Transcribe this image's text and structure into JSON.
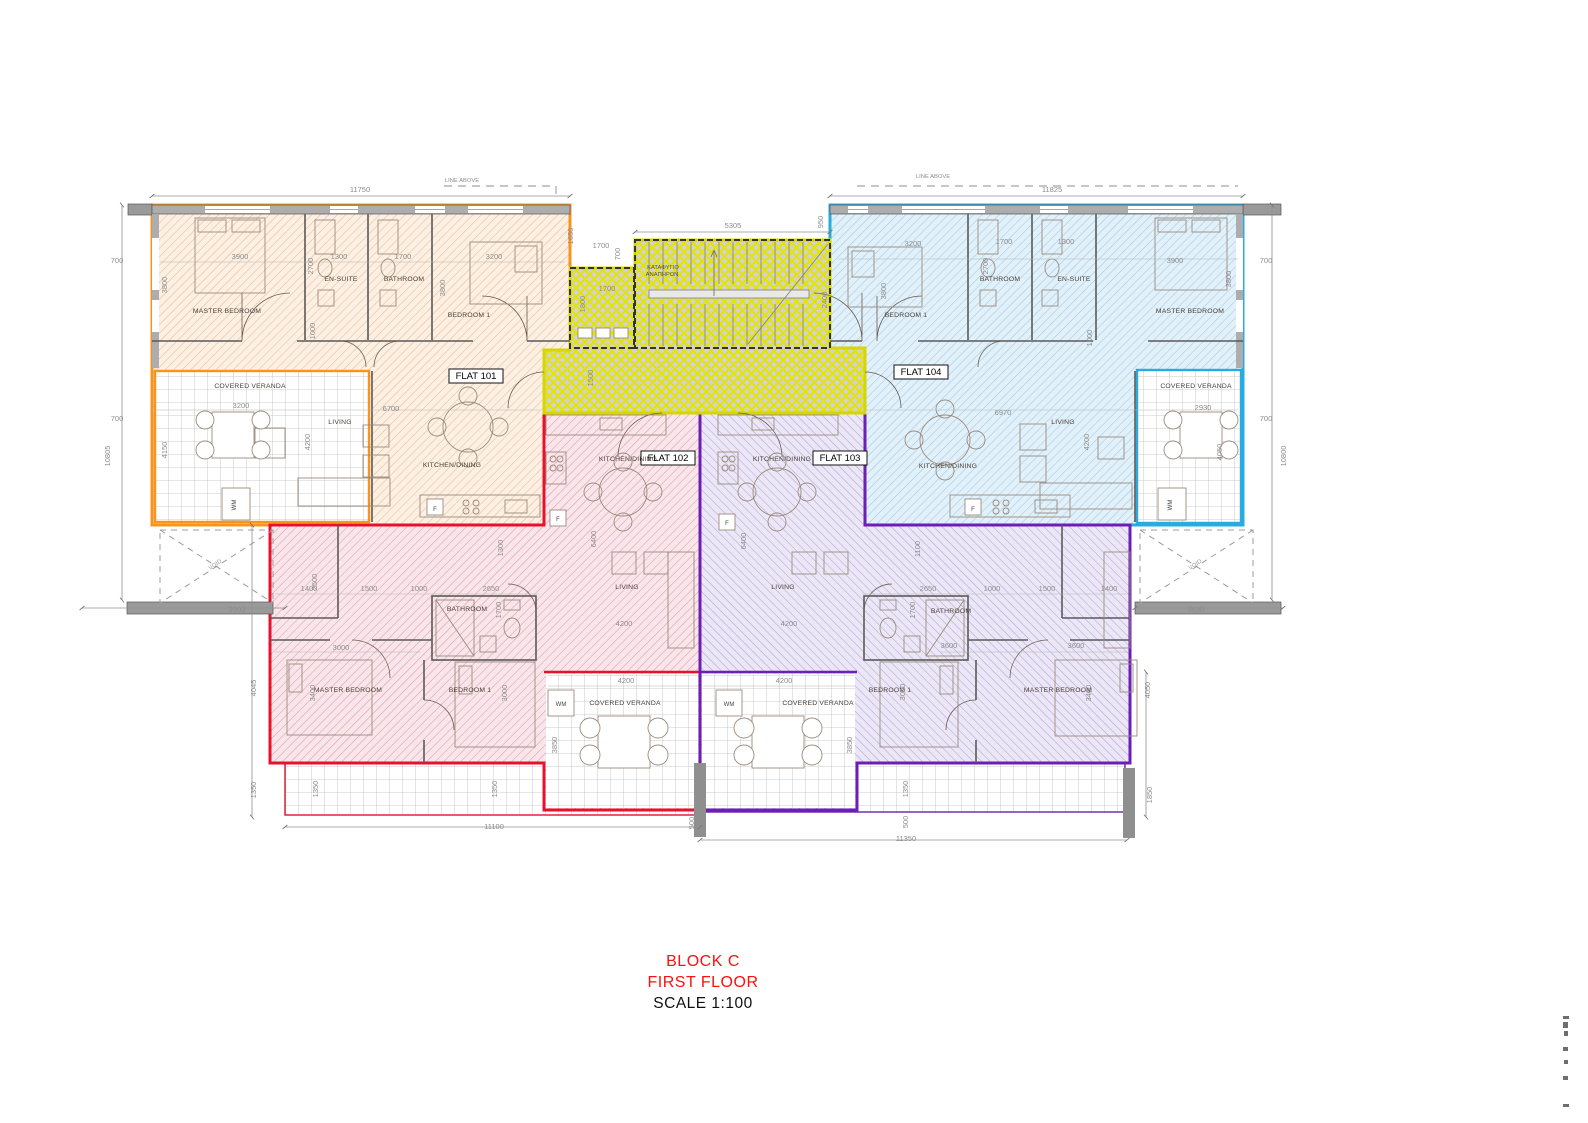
{
  "document": {
    "type": "architectural-floor-plan",
    "sheet_width_px": 1588,
    "sheet_height_px": 1123
  },
  "title": {
    "block": "BLOCK C",
    "floor": "FIRST FLOOR",
    "scale": "SCALE 1:100"
  },
  "colors": {
    "flat101_border": "#F7941E",
    "flat102_border": "#E8112D",
    "flat103_border": "#6C1EB5",
    "flat104_border": "#29ABE2",
    "core_border": "#D6D600",
    "core_hatch": "#E8E800",
    "dim_text": "#8C8C8C",
    "room_text": "#4A4038",
    "title_red": "#FF0F0F"
  },
  "flats": [
    {
      "id": "FLAT 101",
      "position": "top-left",
      "border": "#F7941E",
      "rooms": [
        "MASTER BEDROOM",
        "EN-SUITE",
        "BATHROOM",
        "BEDROOM 1",
        "LIVING",
        "KITCHEN/DINING",
        "COVERED VERANDA"
      ]
    },
    {
      "id": "FLAT 102",
      "position": "bottom-left",
      "border": "#E8112D",
      "rooms": [
        "KITCHEN/DINING",
        "LIVING",
        "BATHROOM",
        "MASTER BEDROOM",
        "BEDROOM 1",
        "COVERED VERANDA"
      ]
    },
    {
      "id": "FLAT 103",
      "position": "bottom-right",
      "border": "#6C1EB5",
      "rooms": [
        "KITCHEN/DINING",
        "LIVING",
        "BATHROOM",
        "BEDROOM 1",
        "MASTER BEDROOM",
        "COVERED VERANDA"
      ]
    },
    {
      "id": "FLAT 104",
      "position": "top-right",
      "border": "#29ABE2",
      "rooms": [
        "BEDROOM 1",
        "BATHROOM",
        "EN-SUITE",
        "MASTER BEDROOM",
        "LIVING",
        "KITCHEN/DINING",
        "COVERED VERANDA"
      ]
    }
  ],
  "core_labels": [
    {
      "t": "ΚΑΤΑΦΥΓΙΟ",
      "x": 663,
      "y": 269
    },
    {
      "t": "ΑΝΑΠΗΡΩΝ",
      "x": 662,
      "y": 276
    }
  ],
  "flat_tags": [
    {
      "t": "FLAT 101",
      "x": 476,
      "y": 379
    },
    {
      "t": "FLAT 102",
      "x": 668,
      "y": 461
    },
    {
      "t": "FLAT 103",
      "x": 840,
      "y": 461
    },
    {
      "t": "FLAT 104",
      "x": 921,
      "y": 375
    }
  ],
  "room_labels": [
    {
      "t": "MASTER BEDROOM",
      "x": 227,
      "y": 313
    },
    {
      "t": "EN-SUITE",
      "x": 341,
      "y": 281
    },
    {
      "t": "BATHROOM",
      "x": 404,
      "y": 281
    },
    {
      "t": "BEDROOM 1",
      "x": 469,
      "y": 317
    },
    {
      "t": "COVERED VERANDA",
      "x": 250,
      "y": 388
    },
    {
      "t": "LIVING",
      "x": 340,
      "y": 424
    },
    {
      "t": "KITCHEN/DINING",
      "x": 452,
      "y": 467
    },
    {
      "t": "BEDROOM 1",
      "x": 906,
      "y": 317
    },
    {
      "t": "BATHROOM",
      "x": 1000,
      "y": 281
    },
    {
      "t": "EN-SUITE",
      "x": 1074,
      "y": 281
    },
    {
      "t": "MASTER BEDROOM",
      "x": 1190,
      "y": 313
    },
    {
      "t": "LIVING",
      "x": 1063,
      "y": 424
    },
    {
      "t": "KITCHEN/DINING",
      "x": 948,
      "y": 468
    },
    {
      "t": "COVERED VERANDA",
      "x": 1196,
      "y": 388
    },
    {
      "t": "KITCHEN/DINING",
      "x": 628,
      "y": 461
    },
    {
      "t": "LIVING",
      "x": 627,
      "y": 589
    },
    {
      "t": "BATHROOM",
      "x": 467,
      "y": 611
    },
    {
      "t": "MASTER BEDROOM",
      "x": 348,
      "y": 692
    },
    {
      "t": "BEDROOM 1",
      "x": 470,
      "y": 692
    },
    {
      "t": "COVERED VERANDA",
      "x": 625,
      "y": 705
    },
    {
      "t": "KITCHEN/DINING",
      "x": 782,
      "y": 461
    },
    {
      "t": "LIVING",
      "x": 783,
      "y": 589
    },
    {
      "t": "BATHROOM",
      "x": 951,
      "y": 613
    },
    {
      "t": "BEDROOM 1",
      "x": 890,
      "y": 692
    },
    {
      "t": "MASTER BEDROOM",
      "x": 1058,
      "y": 692
    },
    {
      "t": "COVERED VERANDA",
      "x": 818,
      "y": 705
    }
  ],
  "appliance_labels": [
    {
      "t": "F",
      "x": 435,
      "y": 511
    },
    {
      "t": "F",
      "x": 973,
      "y": 511
    },
    {
      "t": "F",
      "x": 558,
      "y": 521
    },
    {
      "t": "F",
      "x": 727,
      "y": 525
    },
    {
      "t": "WM",
      "x": 236,
      "y": 505,
      "r": -90
    },
    {
      "t": "WM",
      "x": 1172,
      "y": 505,
      "r": -90
    },
    {
      "t": "WM",
      "x": 561,
      "y": 706
    },
    {
      "t": "WM",
      "x": 729,
      "y": 706
    }
  ],
  "void_labels": [
    {
      "t": "VOID",
      "x": 216,
      "y": 566,
      "r": -33
    },
    {
      "t": "VOID",
      "x": 1196,
      "y": 566,
      "r": -33
    }
  ],
  "line_above_labels": [
    {
      "t": "LINE ABOVE",
      "x": 462,
      "y": 182
    },
    {
      "t": "LINE ABOVE",
      "x": 933,
      "y": 178
    }
  ],
  "dim_labels": [
    {
      "t": "11750",
      "x": 360,
      "y": 192
    },
    {
      "t": "11825",
      "x": 1052,
      "y": 192
    },
    {
      "t": "5305",
      "x": 733,
      "y": 228
    },
    {
      "t": "950",
      "x": 823,
      "y": 222,
      "r": -90
    },
    {
      "t": "1650",
      "x": 573,
      "y": 236,
      "r": -90
    },
    {
      "t": "700",
      "x": 117,
      "y": 263
    },
    {
      "t": "3800",
      "x": 167,
      "y": 285,
      "r": -90
    },
    {
      "t": "700",
      "x": 117,
      "y": 421
    },
    {
      "t": "4150",
      "x": 167,
      "y": 450,
      "r": -90
    },
    {
      "t": "10805",
      "x": 110,
      "y": 456,
      "r": -90
    },
    {
      "t": "3900",
      "x": 237,
      "y": 612
    },
    {
      "t": "700",
      "x": 1266,
      "y": 263
    },
    {
      "t": "3800",
      "x": 1231,
      "y": 279,
      "r": -90
    },
    {
      "t": "700",
      "x": 1266,
      "y": 421
    },
    {
      "t": "10800",
      "x": 1286,
      "y": 456,
      "r": -90
    },
    {
      "t": "3630",
      "x": 1196,
      "y": 612
    },
    {
      "t": "3900",
      "x": 240,
      "y": 259
    },
    {
      "t": "1300",
      "x": 339,
      "y": 259
    },
    {
      "t": "1700",
      "x": 403,
      "y": 259
    },
    {
      "t": "3200",
      "x": 494,
      "y": 259
    },
    {
      "t": "2700",
      "x": 313,
      "y": 266,
      "r": -90
    },
    {
      "t": "3800",
      "x": 445,
      "y": 288,
      "r": -90
    },
    {
      "t": "1000",
      "x": 315,
      "y": 331,
      "r": -90
    },
    {
      "t": "3200",
      "x": 241,
      "y": 408
    },
    {
      "t": "6700",
      "x": 391,
      "y": 411
    },
    {
      "t": "4200",
      "x": 310,
      "y": 442,
      "r": -90
    },
    {
      "t": "1700",
      "x": 601,
      "y": 248
    },
    {
      "t": "700",
      "x": 620,
      "y": 254,
      "r": -90
    },
    {
      "t": "1700",
      "x": 607,
      "y": 291
    },
    {
      "t": "1800",
      "x": 585,
      "y": 304,
      "r": -90
    },
    {
      "t": "2400",
      "x": 827,
      "y": 300,
      "r": -90
    },
    {
      "t": "1500",
      "x": 593,
      "y": 378,
      "r": -90
    },
    {
      "t": "3200",
      "x": 913,
      "y": 246
    },
    {
      "t": "1700",
      "x": 1004,
      "y": 244
    },
    {
      "t": "1300",
      "x": 1066,
      "y": 244
    },
    {
      "t": "3900",
      "x": 1175,
      "y": 263
    },
    {
      "t": "2700",
      "x": 988,
      "y": 266,
      "r": -90
    },
    {
      "t": "3800",
      "x": 886,
      "y": 291,
      "r": -90
    },
    {
      "t": "1000",
      "x": 1092,
      "y": 338,
      "r": -90
    },
    {
      "t": "6970",
      "x": 1003,
      "y": 415
    },
    {
      "t": "4200",
      "x": 1089,
      "y": 442,
      "r": -90
    },
    {
      "t": "2930",
      "x": 1203,
      "y": 410
    },
    {
      "t": "4050",
      "x": 1222,
      "y": 452,
      "r": -90
    },
    {
      "t": "1300",
      "x": 503,
      "y": 548,
      "r": -90
    },
    {
      "t": "6400",
      "x": 596,
      "y": 539,
      "r": -90
    },
    {
      "t": "4200",
      "x": 624,
      "y": 626
    },
    {
      "t": "1400",
      "x": 309,
      "y": 591
    },
    {
      "t": "1500",
      "x": 369,
      "y": 591
    },
    {
      "t": "1000",
      "x": 419,
      "y": 591
    },
    {
      "t": "2650",
      "x": 491,
      "y": 591
    },
    {
      "t": "1700",
      "x": 501,
      "y": 610,
      "r": -90
    },
    {
      "t": "2500",
      "x": 317,
      "y": 582,
      "r": -90
    },
    {
      "t": "3000",
      "x": 341,
      "y": 650
    },
    {
      "t": "3400",
      "x": 315,
      "y": 693,
      "r": -90
    },
    {
      "t": "3000",
      "x": 507,
      "y": 693,
      "r": -90
    },
    {
      "t": "4045",
      "x": 256,
      "y": 688,
      "r": -90
    },
    {
      "t": "1350",
      "x": 256,
      "y": 790,
      "r": -90
    },
    {
      "t": "4200",
      "x": 626,
      "y": 683
    },
    {
      "t": "3850",
      "x": 557,
      "y": 745,
      "r": -90
    },
    {
      "t": "1350",
      "x": 318,
      "y": 789,
      "r": -90
    },
    {
      "t": "1350",
      "x": 497,
      "y": 789,
      "r": -90
    },
    {
      "t": "11100",
      "x": 494,
      "y": 829
    },
    {
      "t": "500",
      "x": 694,
      "y": 823,
      "r": -90
    },
    {
      "t": "1100",
      "x": 920,
      "y": 549,
      "r": -90
    },
    {
      "t": "6400",
      "x": 746,
      "y": 541,
      "r": -90
    },
    {
      "t": "4200",
      "x": 789,
      "y": 626
    },
    {
      "t": "2650",
      "x": 928,
      "y": 591
    },
    {
      "t": "1000",
      "x": 992,
      "y": 591
    },
    {
      "t": "1500",
      "x": 1047,
      "y": 591
    },
    {
      "t": "1400",
      "x": 1109,
      "y": 591
    },
    {
      "t": "1700",
      "x": 915,
      "y": 610,
      "r": -90
    },
    {
      "t": "3600",
      "x": 949,
      "y": 648
    },
    {
      "t": "3600",
      "x": 1076,
      "y": 648
    },
    {
      "t": "3400",
      "x": 1091,
      "y": 693,
      "r": -90
    },
    {
      "t": "3000",
      "x": 905,
      "y": 692,
      "r": -90
    },
    {
      "t": "4200",
      "x": 784,
      "y": 683
    },
    {
      "t": "3850",
      "x": 852,
      "y": 745,
      "r": -90
    },
    {
      "t": "1350",
      "x": 908,
      "y": 789,
      "r": -90
    },
    {
      "t": "500",
      "x": 908,
      "y": 822,
      "r": -90
    },
    {
      "t": "11350",
      "x": 906,
      "y": 841
    },
    {
      "t": "1850",
      "x": 1152,
      "y": 795,
      "r": -90
    },
    {
      "t": "4050",
      "x": 1150,
      "y": 690,
      "r": -90
    }
  ]
}
